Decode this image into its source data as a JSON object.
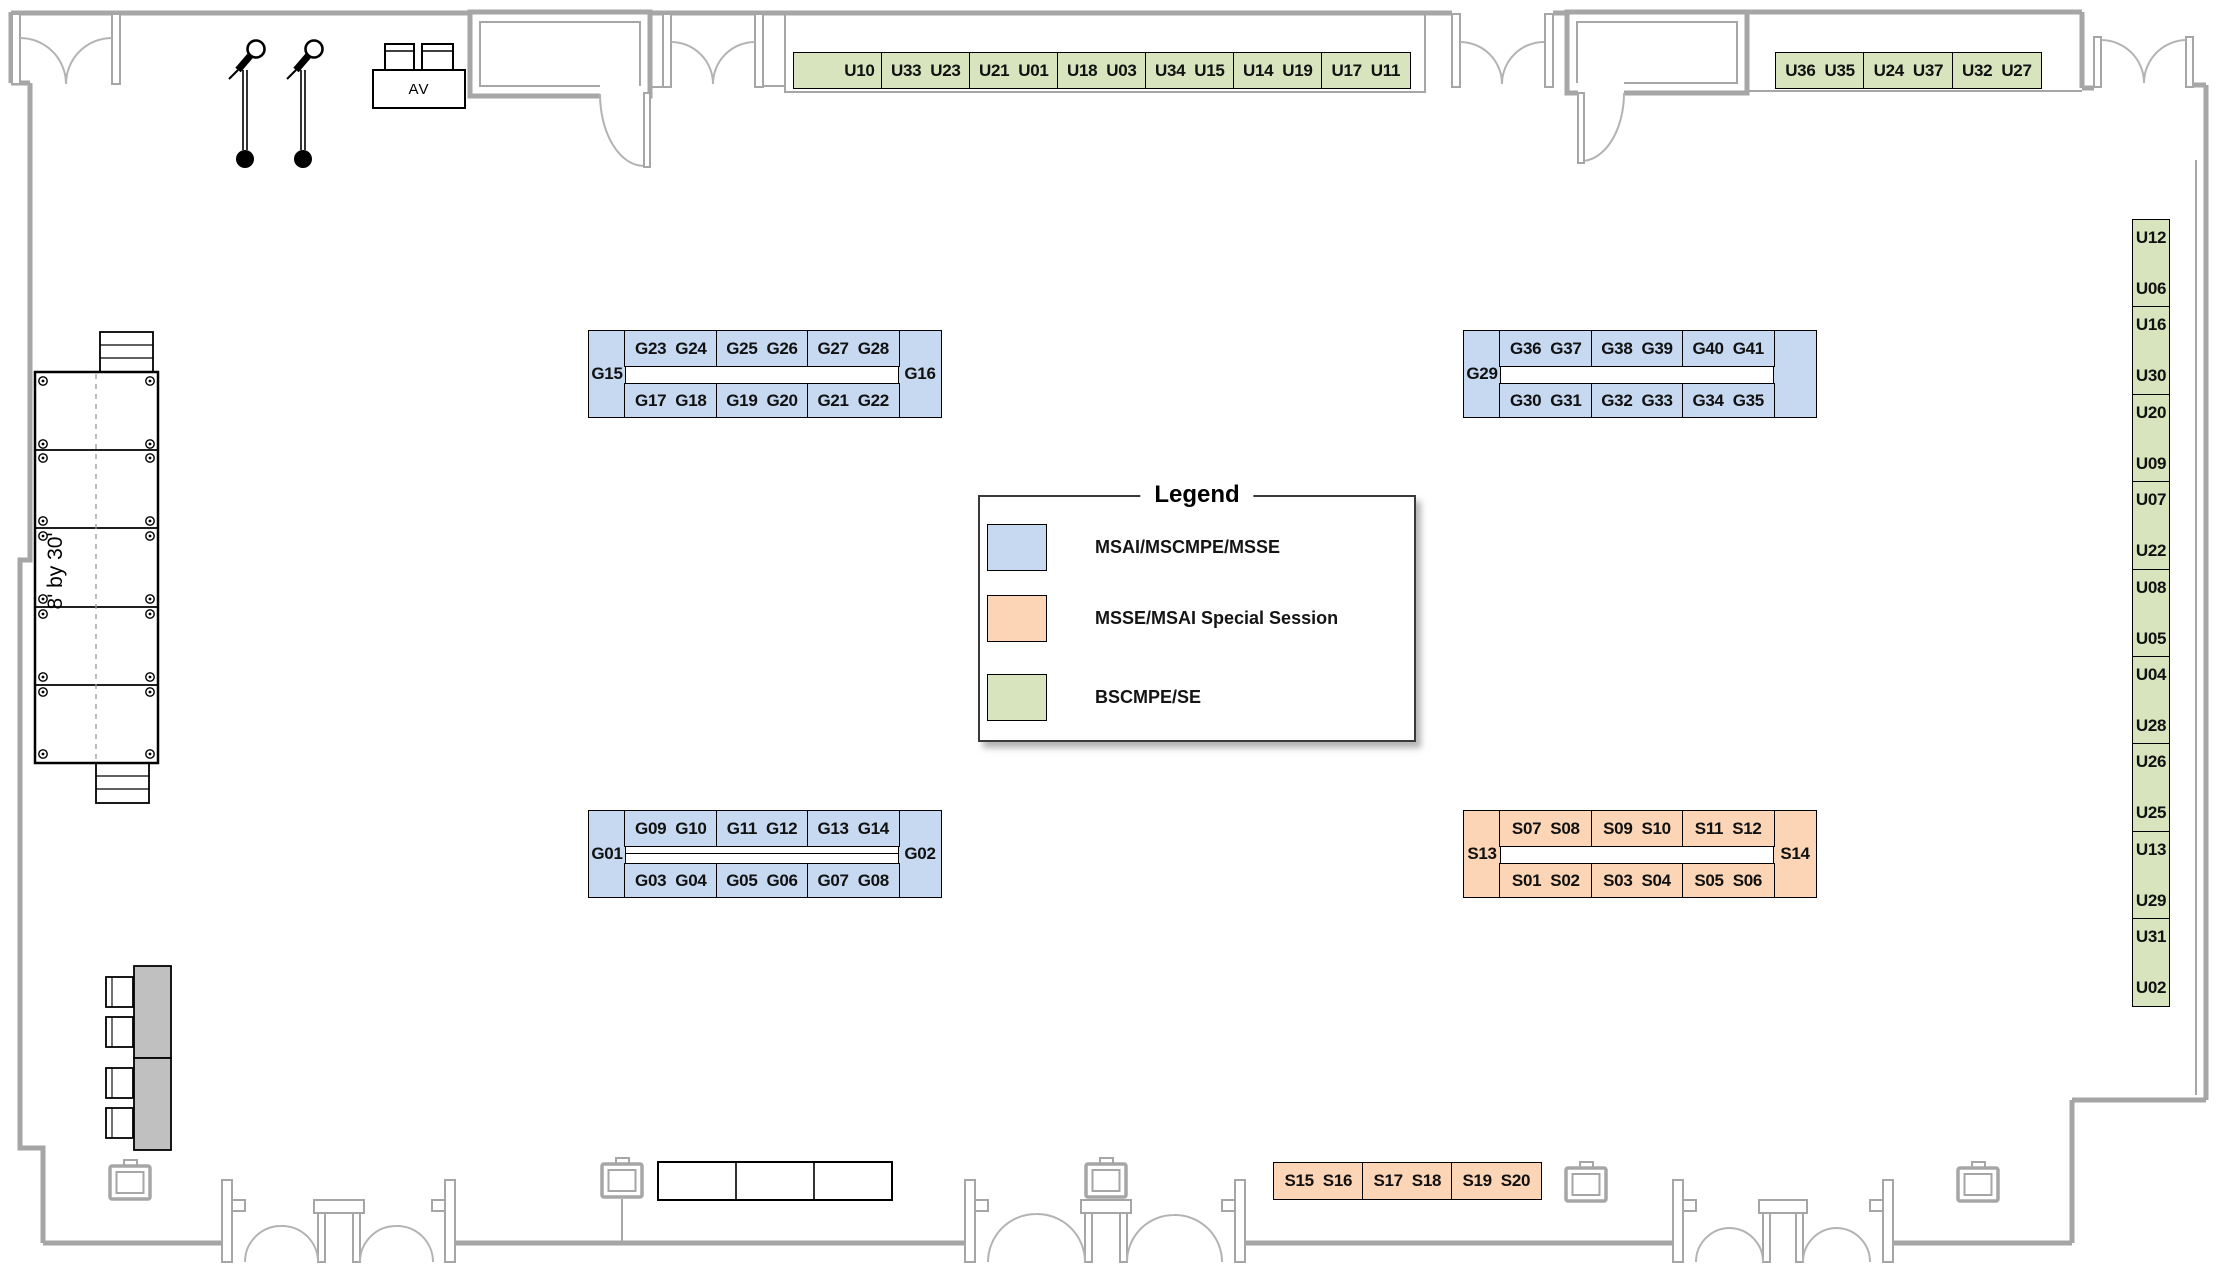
{
  "colors": {
    "blue": "#c6d9f1",
    "orange": "#fbd5b5",
    "green": "#d7e4bd",
    "wall": "#a6a6a6",
    "table_gray": "#c0c0c0"
  },
  "legend": {
    "title": "Legend",
    "items": [
      {
        "label": "MSAI/MSCMPE/MSSE",
        "color": "blue"
      },
      {
        "label": "MSSE/MSAI Special Session",
        "color": "orange"
      },
      {
        "label": "BSCMPE/SE",
        "color": "green"
      }
    ]
  },
  "stage": {
    "label": "8' by 30'"
  },
  "av_table": {
    "label": "AV"
  },
  "booth_groups": {
    "top_strip": {
      "color": "green",
      "cells": [
        [
          "U10"
        ],
        [
          "U33",
          "U23"
        ],
        [
          "U21",
          "U01"
        ],
        [
          "U18",
          "U03"
        ],
        [
          "U34",
          "U15"
        ],
        [
          "U14",
          "U19"
        ],
        [
          "U17",
          "U11"
        ]
      ]
    },
    "top_right_strip": {
      "color": "green",
      "cells": [
        [
          "U36",
          "U35"
        ],
        [
          "U24",
          "U37"
        ],
        [
          "U32",
          "U27"
        ]
      ]
    },
    "right_column": {
      "color": "green",
      "cells": [
        [
          "U12",
          "U06"
        ],
        [
          "U16",
          "U30"
        ],
        [
          "U20",
          "U09"
        ],
        [
          "U07",
          "U22"
        ],
        [
          "U08",
          "U05"
        ],
        [
          "U04",
          "U28"
        ],
        [
          "U26",
          "U25"
        ],
        [
          "U13",
          "U29"
        ],
        [
          "U31",
          "U02"
        ]
      ]
    },
    "south_strip": {
      "color": "orange",
      "cells": [
        [
          "S15",
          "S16"
        ],
        [
          "S17",
          "S18"
        ],
        [
          "S19",
          "S20"
        ]
      ]
    },
    "clusters": [
      {
        "id": "nw",
        "color": "blue",
        "left_cap": "G15",
        "right_cap": "G16",
        "divider": false,
        "top_cells": [
          [
            "G23",
            "G24"
          ],
          [
            "G25",
            "G26"
          ],
          [
            "G27",
            "G28"
          ]
        ],
        "bottom_cells": [
          [
            "G17",
            "G18"
          ],
          [
            "G19",
            "G20"
          ],
          [
            "G21",
            "G22"
          ]
        ]
      },
      {
        "id": "ne",
        "color": "blue",
        "left_cap": "G29",
        "right_cap": "",
        "divider": false,
        "top_cells": [
          [
            "G36",
            "G37"
          ],
          [
            "G38",
            "G39"
          ],
          [
            "G40",
            "G41"
          ]
        ],
        "bottom_cells": [
          [
            "G30",
            "G31"
          ],
          [
            "G32",
            "G33"
          ],
          [
            "G34",
            "G35"
          ]
        ]
      },
      {
        "id": "sw",
        "color": "blue",
        "left_cap": "G01",
        "right_cap": "G02",
        "divider": true,
        "top_cells": [
          [
            "G09",
            "G10"
          ],
          [
            "G11",
            "G12"
          ],
          [
            "G13",
            "G14"
          ]
        ],
        "bottom_cells": [
          [
            "G03",
            "G04"
          ],
          [
            "G05",
            "G06"
          ],
          [
            "G07",
            "G08"
          ]
        ]
      },
      {
        "id": "se",
        "color": "orange",
        "left_cap": "S13",
        "right_cap": "S14",
        "divider": false,
        "top_cells": [
          [
            "S07",
            "S08"
          ],
          [
            "S09",
            "S10"
          ],
          [
            "S11",
            "S12"
          ]
        ],
        "bottom_cells": [
          [
            "S01",
            "S02"
          ],
          [
            "S03",
            "S04"
          ],
          [
            "S05",
            "S06"
          ]
        ]
      }
    ]
  }
}
